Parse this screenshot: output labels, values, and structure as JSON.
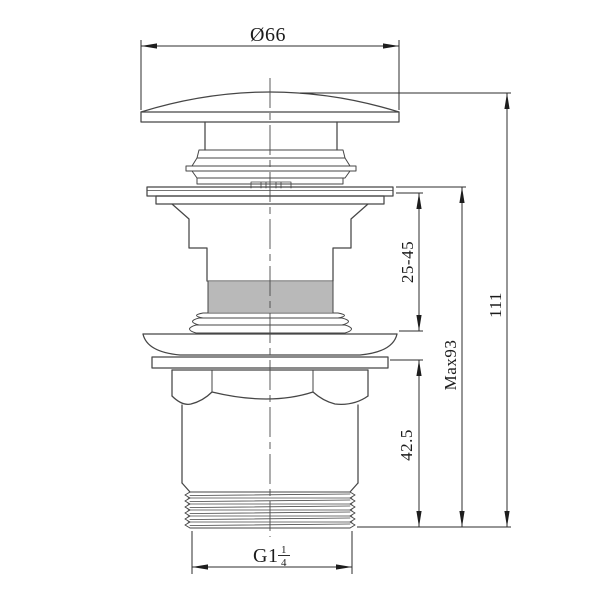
{
  "drawing": {
    "labels": {
      "cap_diameter": "Ø66",
      "overall_height": "111",
      "max_height": "Max93",
      "clamp_range": "25-45",
      "lower_height": "42.5",
      "thread_size_prefix": "G1",
      "thread_fraction_numerator": "1",
      "thread_fraction_denominator": "4"
    },
    "colors": {
      "outline": "#464646",
      "dimension": "#2d2d2d",
      "text": "#1c1c1c",
      "background": "#ffffff"
    }
  }
}
